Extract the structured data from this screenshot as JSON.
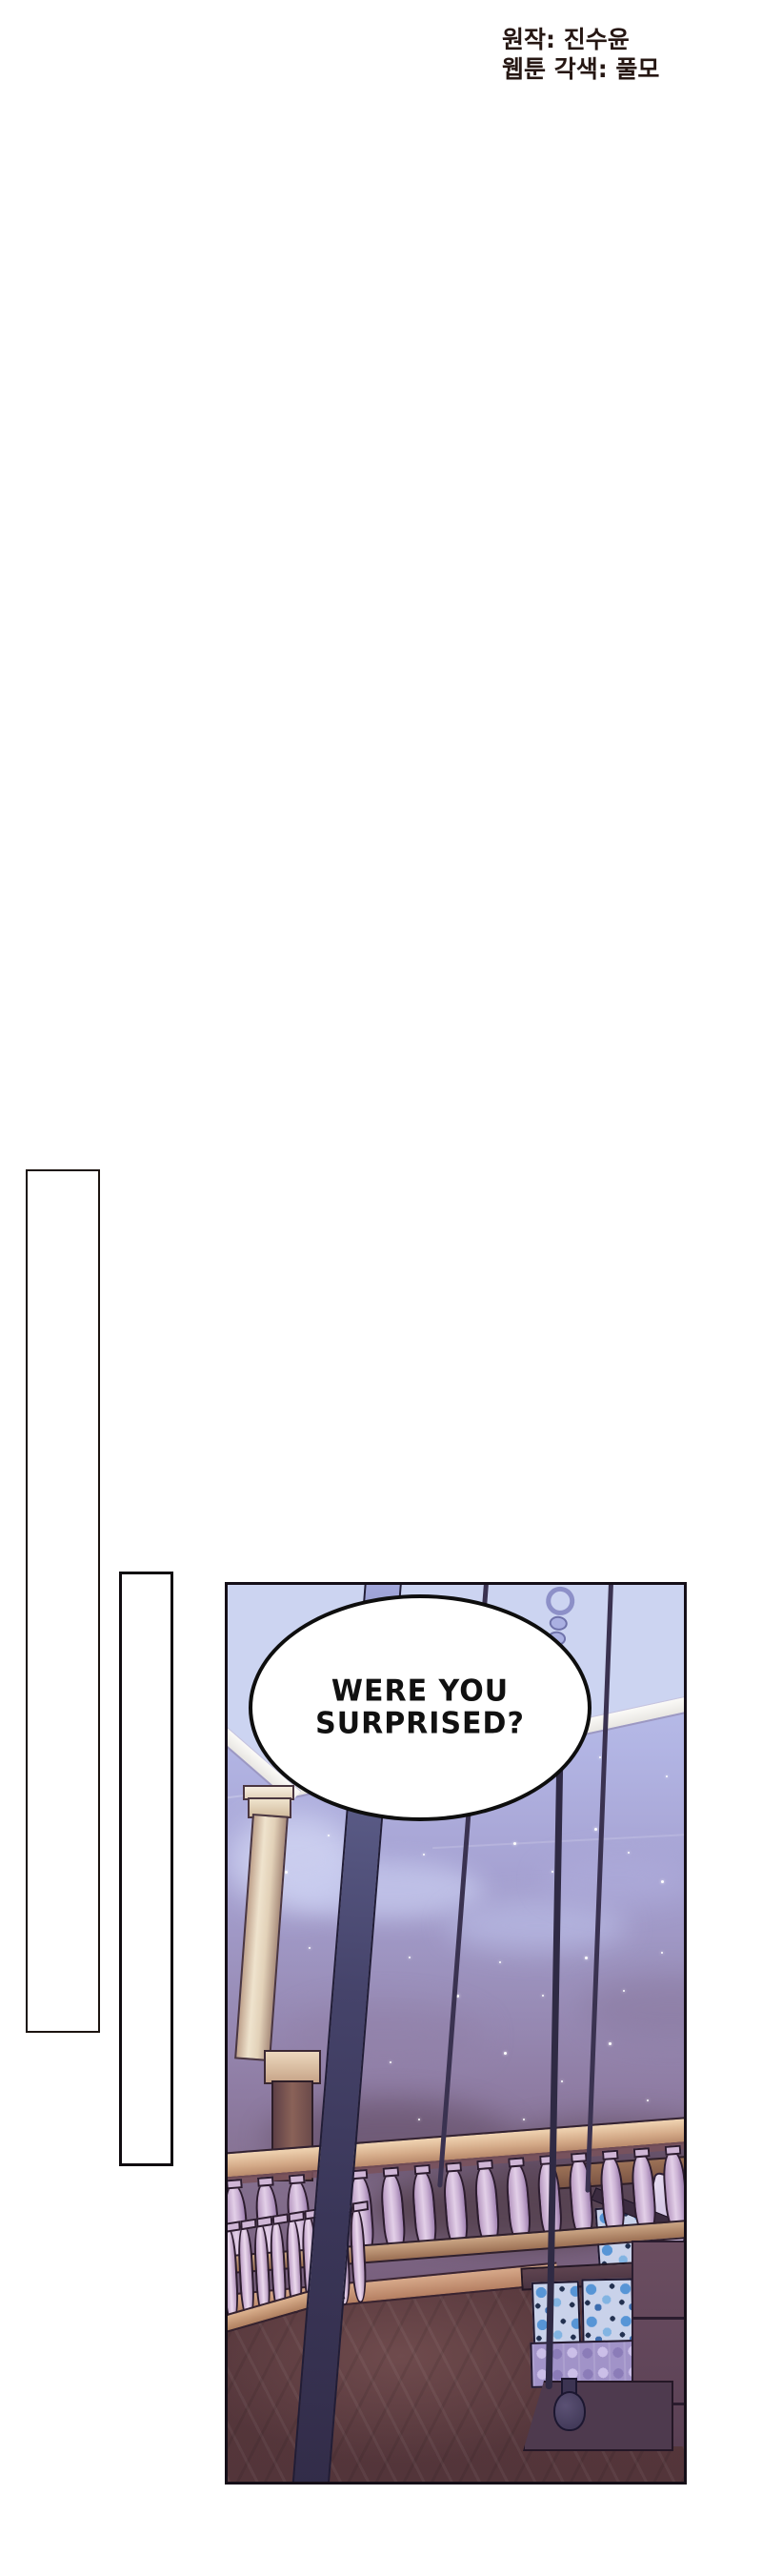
{
  "credits": {
    "original": "원작: 진수윤",
    "adaptation": "웹툰 각색: 풀모",
    "text_color": "#261713"
  },
  "scene_panel": {
    "speech_bubble": {
      "line1": "WERE YOU",
      "line2": "SURPRISED?",
      "text_color": "#111111",
      "border_color": "#0e0e0e"
    },
    "setting": "night balcony with balustrade, column and swing bench",
    "colors": {
      "panel_border": "#150f18",
      "sky_top": "#c2c8ee",
      "sky_bottom": "#684f66",
      "ceiling": "#ccd4f1",
      "ceiling_beam": "#fbfaf7",
      "column": "#efe3cd",
      "railing_wood": "#d3a987",
      "baluster": "#cbb2d4",
      "floor_wood": "#5d3c40",
      "swing_pole": "#45436a",
      "bench_plum": "#6b4e61",
      "cushion_floral_blue": "#5795d6",
      "cushion_lavender": "#a193c8",
      "star": "#ffffff"
    }
  },
  "empty_frames": {
    "frame1_border": "#1c1410",
    "frame2_border": "#100c10"
  }
}
